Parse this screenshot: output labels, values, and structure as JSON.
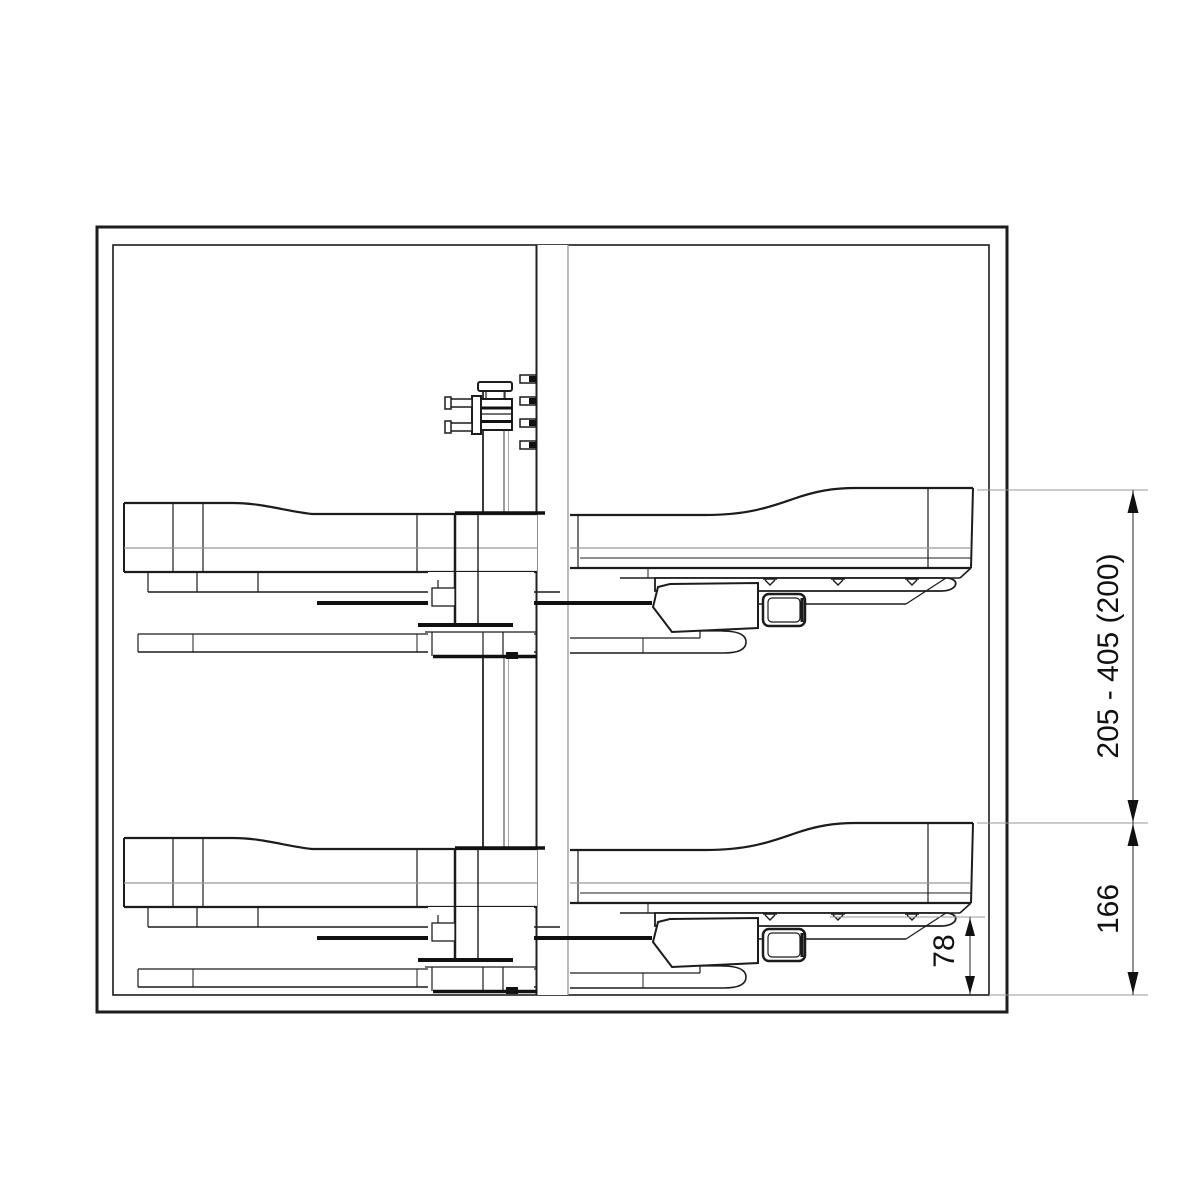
{
  "diagram": {
    "kind": "technical-drawing-cabinet-pullout-shelf-elevation",
    "dimensions": [
      {
        "id": "mounting-height-range",
        "label": "205 - 405 (200)"
      },
      {
        "id": "lower-shelf-height",
        "label": "166"
      },
      {
        "id": "rail-to-bottom-clearance",
        "label": "78"
      }
    ],
    "colors": {
      "line": "#1c1c1c",
      "secondary_line": "#999999",
      "dimension_line": "#4a4a4a",
      "extension_line": "#9a9a9a",
      "background": "#ffffff"
    }
  }
}
